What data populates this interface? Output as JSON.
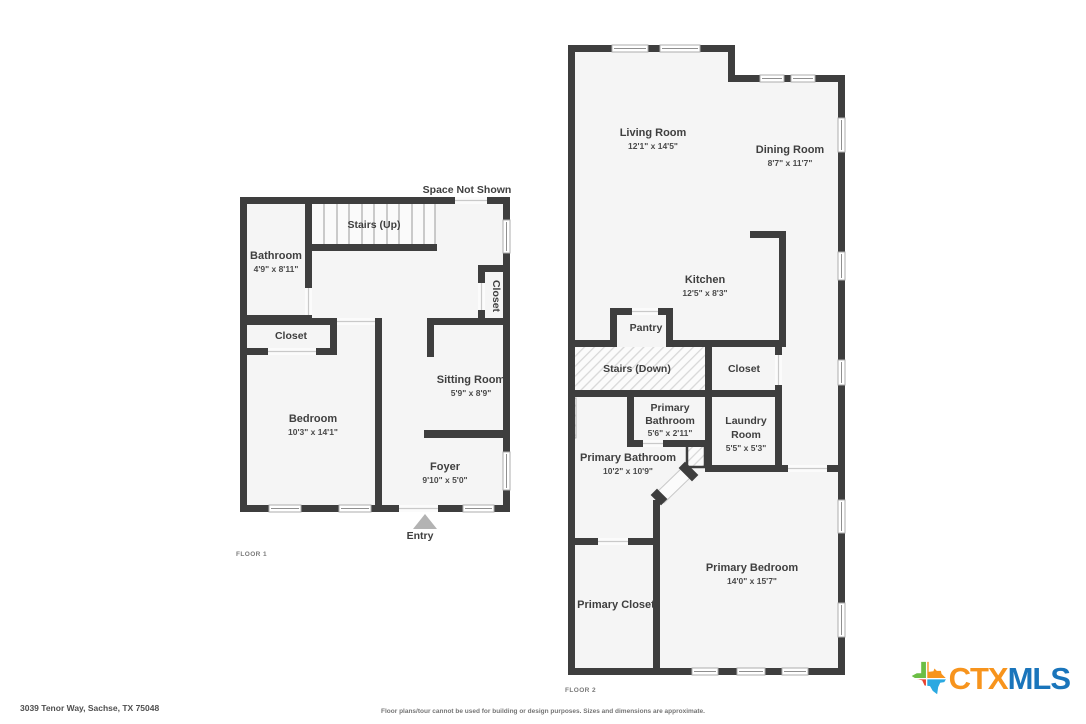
{
  "floors": {
    "floor1": {
      "tag": "FLOOR 1",
      "space_note": "Space Not Shown",
      "entry": "Entry",
      "rooms": {
        "stairs": {
          "name": "Stairs (Up)"
        },
        "bathroom": {
          "name": "Bathroom",
          "dims": "4'9\" x 8'11\""
        },
        "closet": {
          "name": "Closet"
        },
        "bedroom": {
          "name": "Bedroom",
          "dims": "10'3\" x 14'1\""
        },
        "sitting_room": {
          "name": "Sitting Room",
          "dims": "5'9\" x 8'9\""
        },
        "hall_closet": {
          "name": "Closet"
        },
        "foyer": {
          "name": "Foyer",
          "dims": "9'10\" x 5'0\""
        }
      }
    },
    "floor2": {
      "tag": "FLOOR 2",
      "rooms": {
        "living_room": {
          "name": "Living Room",
          "dims": "12'1\" x 14'5\""
        },
        "dining_room": {
          "name": "Dining Room",
          "dims": "8'7\" x 11'7\""
        },
        "kitchen": {
          "name": "Kitchen",
          "dims": "12'5\" x 8'3\""
        },
        "pantry": {
          "name": "Pantry"
        },
        "stairs": {
          "name": "Stairs (Down)"
        },
        "closet": {
          "name": "Closet"
        },
        "primary_bathroom_small": {
          "line1": "Primary",
          "line2": "Bathroom",
          "dims": "5'6\" x 2'11\""
        },
        "laundry": {
          "line1": "Laundry",
          "line2": "Room",
          "dims": "5'5\" x 5'3\""
        },
        "primary_bathroom": {
          "name": "Primary Bathroom",
          "dims": "10'2\" x 10'9\""
        },
        "primary_closet": {
          "name": "Primary Closet"
        },
        "primary_bedroom": {
          "name": "Primary Bedroom",
          "dims": "14'0\" x 15'7\""
        }
      }
    }
  },
  "footer": {
    "address": "3039 Tenor Way, Sachse, TX 75048",
    "disclaimer": "Floor plans/tour cannot be used for building or design purposes. Sizes and dimensions are approximate."
  },
  "logo": {
    "ctx": "CTX",
    "mls": "MLS",
    "colors": {
      "orange": "#F7941D",
      "blue": "#1A75BB",
      "green": "#6CBE45",
      "red": "#E8432F",
      "sky": "#2BA9E1"
    }
  },
  "palette": {
    "wall": "#3E3E3E",
    "floor": "#F5F5F5",
    "entry_arrow": "#B3B3B3"
  }
}
